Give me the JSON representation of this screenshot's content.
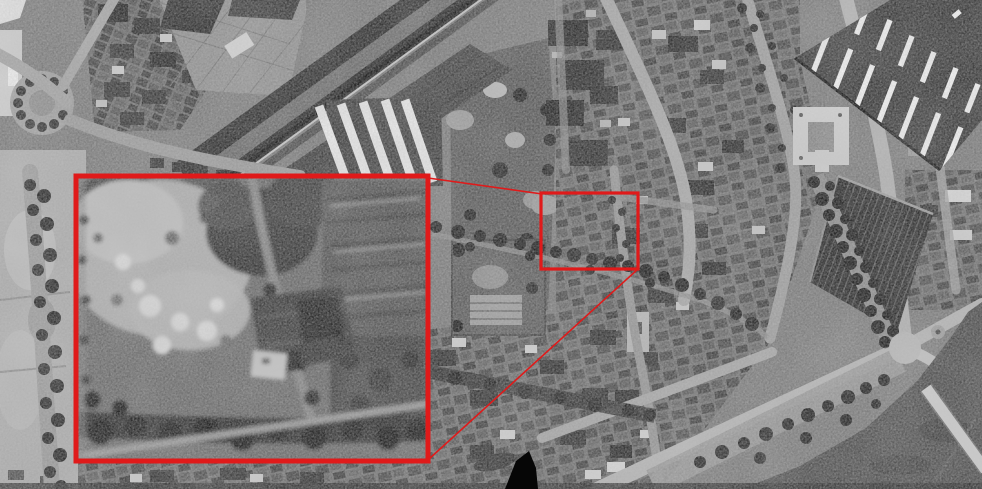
{
  "scene": {
    "description": "Black-and-white vertical aerial photograph of a dense riverside town district; a red rectangle marks an area of interest and red lines connect it to a magnified inset of that area",
    "style": "grayscale-aerial-photo"
  },
  "palette": {
    "photo_base": "#7e7e7e",
    "annotation_red": "#e01a1a",
    "blackout": "#060606"
  },
  "annotation": {
    "color": "#e01a1a",
    "highlight_box": {
      "x": 541,
      "y": 193,
      "width": 97,
      "height": 76
    },
    "inset_box": {
      "x": 76,
      "y": 176,
      "width": 352,
      "height": 285
    },
    "connector_top": {
      "x1": 428,
      "y1": 178,
      "x2": 542,
      "y2": 194
    },
    "connector_bottom": {
      "x1": 638,
      "y1": 269,
      "x2": 429,
      "y2": 459
    }
  },
  "blackout_mark": {
    "color": "#060606",
    "points": "529,451 536,468 538,489 505,489 516,461"
  }
}
